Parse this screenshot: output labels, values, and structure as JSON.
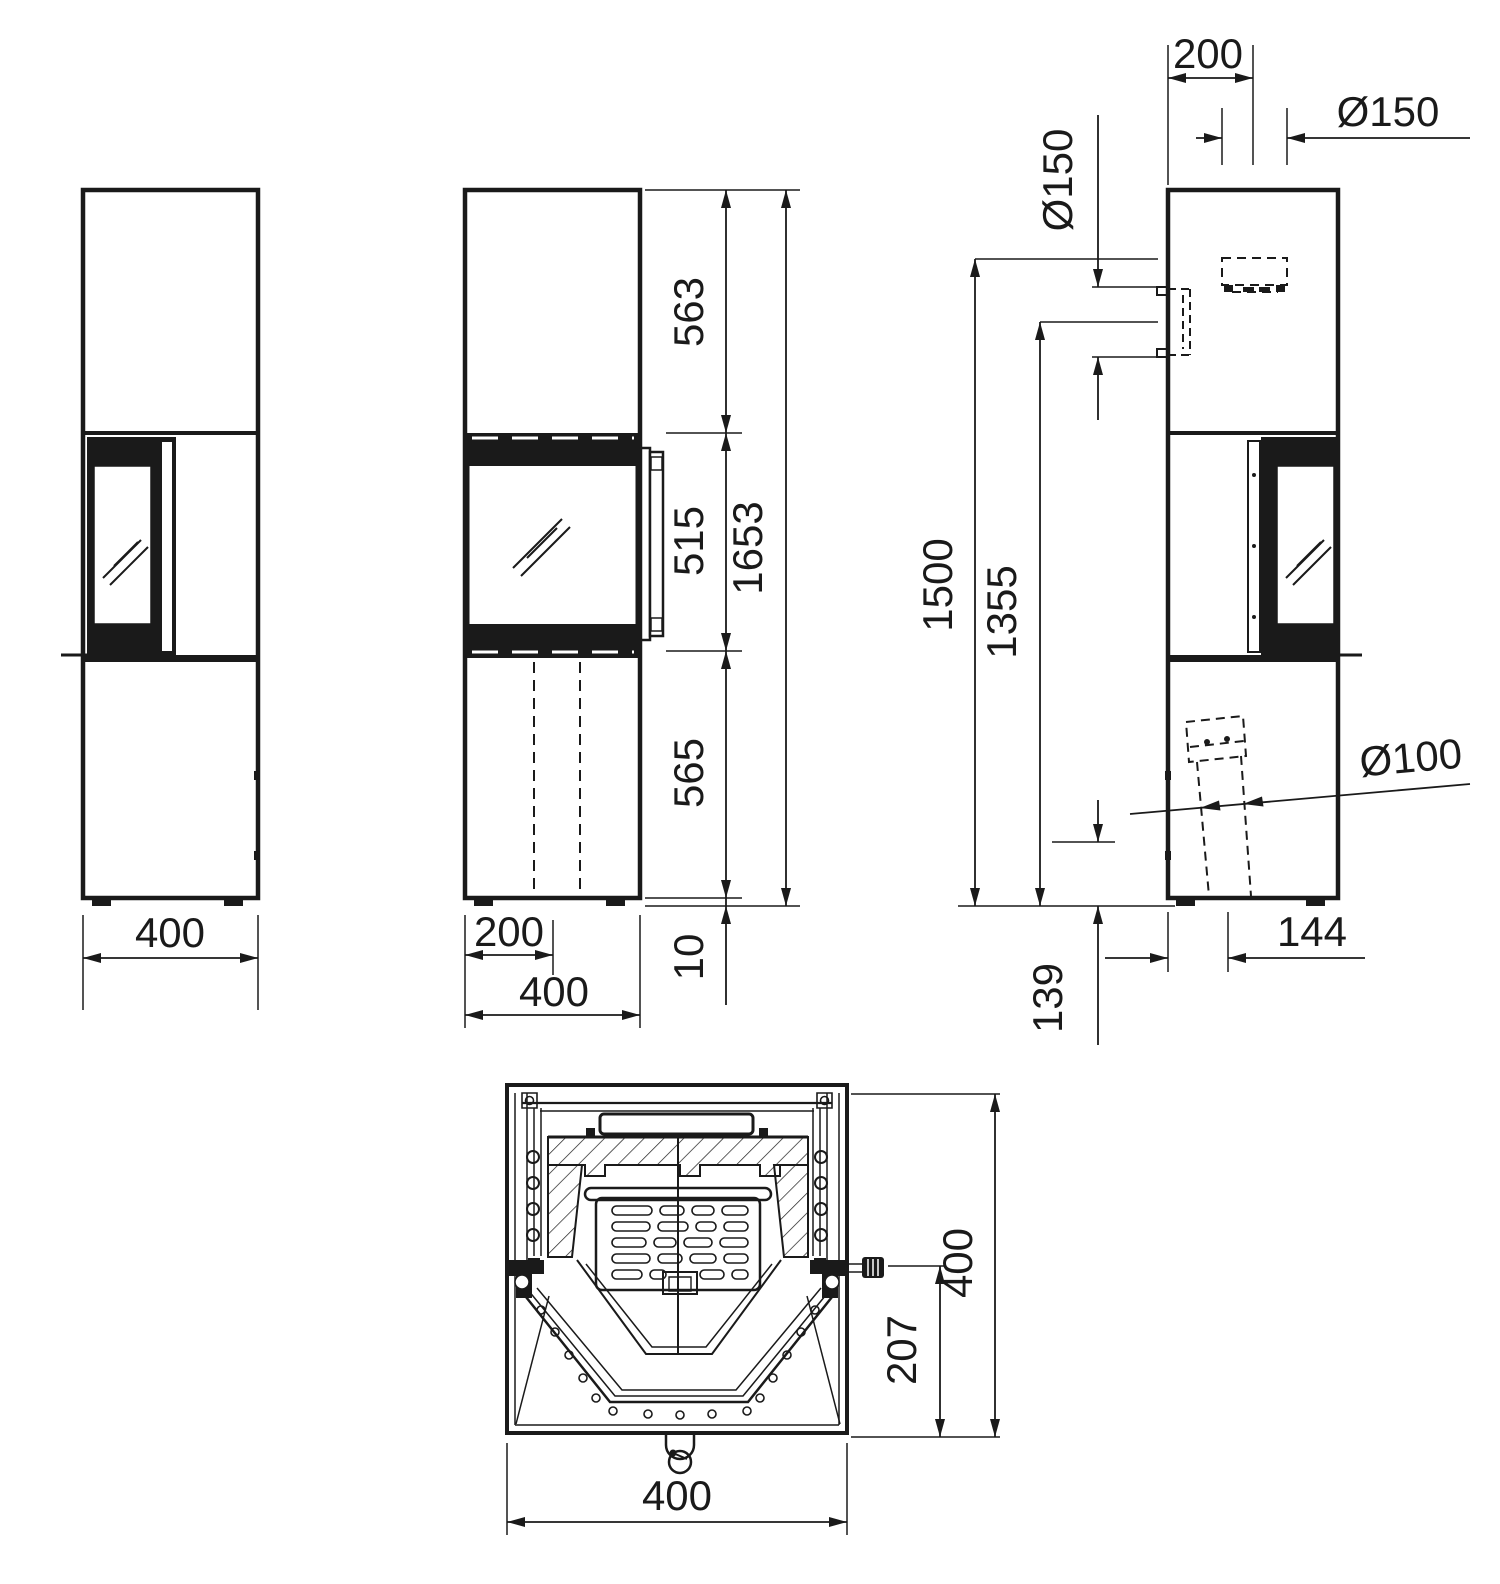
{
  "document": {
    "type": "technical-drawing-stove",
    "background": "#ffffff",
    "line_color": "#1a1a1a",
    "views": [
      "left-elevation",
      "front-elevation",
      "right-elevation",
      "top-section"
    ]
  },
  "dims": {
    "left": {
      "width": "400"
    },
    "front": {
      "seg_top": "563",
      "seg_window": "515",
      "seg_bottom": "565",
      "seg_base": "10",
      "total_height": "1653",
      "half_width": "200",
      "width": "400"
    },
    "side": {
      "flue_top_offset": "200",
      "flue_top_diameter": "Ø150",
      "flue_rear_diameter": "Ø150",
      "flue_top_height": "1500",
      "flue_rear_height": "1355",
      "intake_diameter": "Ø100",
      "intake_offset": "144",
      "intake_height": "139"
    },
    "section": {
      "depth": "400",
      "handle_depth": "207",
      "width": "400"
    }
  }
}
